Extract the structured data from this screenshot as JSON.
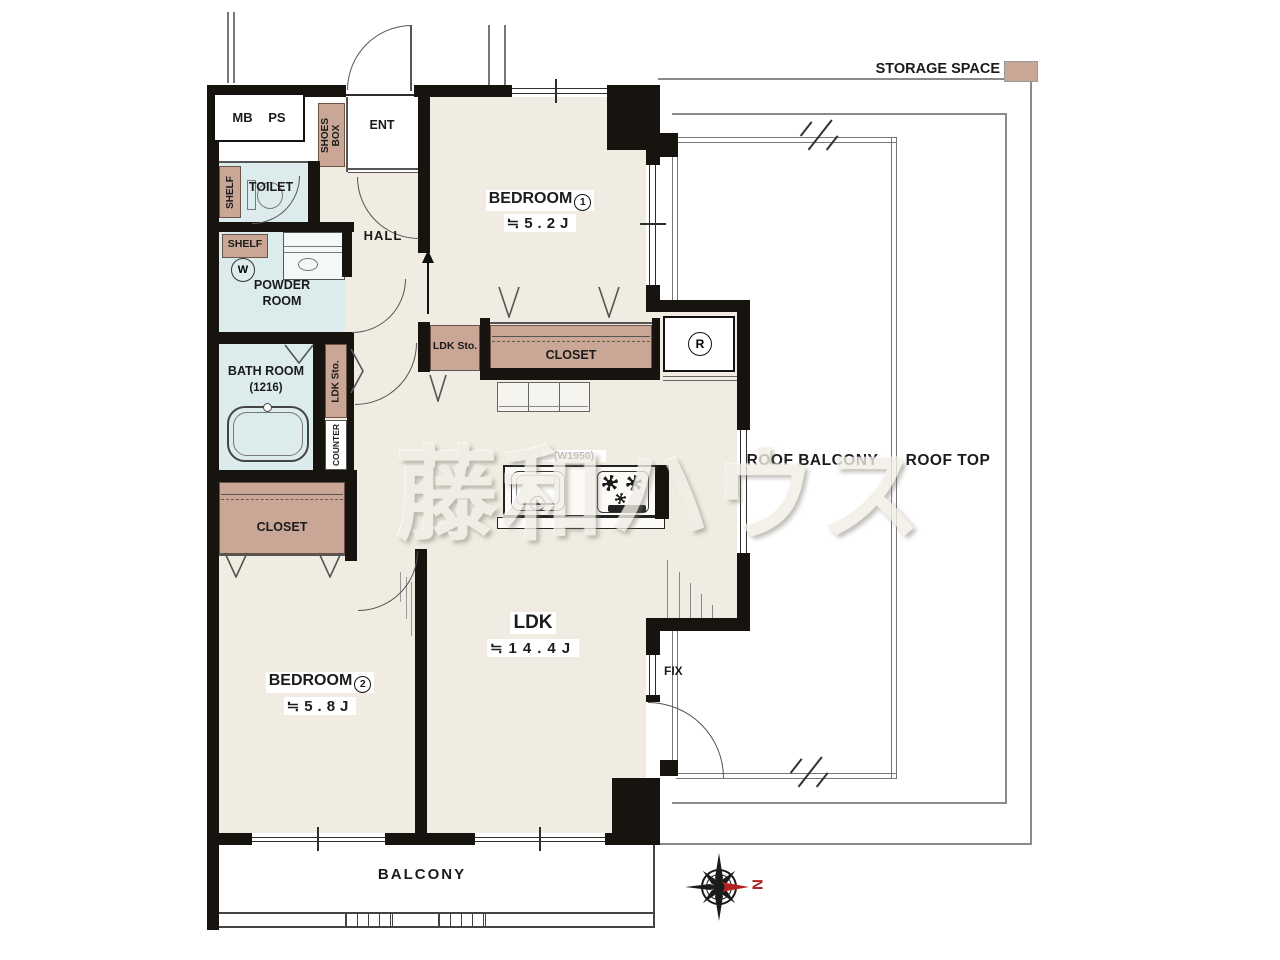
{
  "legend": {
    "storage_space_label": "STORAGE SPACE"
  },
  "watermark_text": "藤和ハウス",
  "compass": {
    "north_label": "N"
  },
  "areas": {
    "roof_balcony": "ROOF BALCONY",
    "roof_top": "ROOF TOP",
    "balcony": "BALCONY"
  },
  "rooms": {
    "bedroom1": {
      "name": "BEDROOM",
      "number": "1",
      "size": "≒5.2J"
    },
    "bedroom2": {
      "name": "BEDROOM",
      "number": "2",
      "size": "≒5.8J"
    },
    "ldk": {
      "name": "LDK",
      "size": "≒14.4J"
    },
    "entrance": "ENT",
    "hall": "HALL",
    "toilet": "TOILET",
    "powder_room": "POWDER ROOM",
    "bath_room": {
      "name": "BATH ROOM",
      "size": "(1216)"
    },
    "mb_ps": "MB PS"
  },
  "storage": {
    "shoes_box": "SHOES BOX",
    "toilet_shelf": "SHELF",
    "powder_shelf": "SHELF",
    "ldk_sto_hall": "LDK Sto.",
    "ldk_sto_bedroom": "LDK Sto.",
    "counter": "COUNTER",
    "closet_bedroom1": "CLOSET",
    "closet_bedroom2": "CLOSET"
  },
  "fixtures": {
    "kitchen_width": "(W1950)",
    "fix_window": "FIX",
    "refrigerator_symbol": "R",
    "washer_symbol": "W"
  },
  "colors": {
    "storage_fill": "#c9a696",
    "wet_area_fill": "#dcebec",
    "floor_fill": "#f0ece1",
    "wall": "#17130e",
    "north_red": "#b32222"
  }
}
